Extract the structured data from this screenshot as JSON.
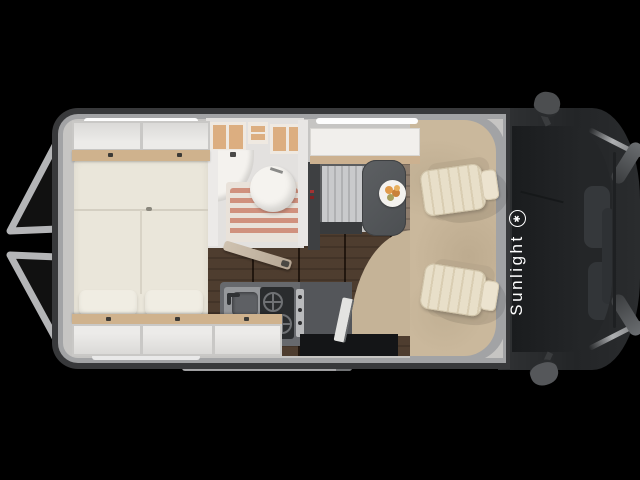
{
  "brand": {
    "name": "Sunlight",
    "logo_glyph": "✱",
    "text_color": "#ffffff"
  },
  "scene": {
    "subject": "camper-van-floor-plan-top-view",
    "orientation": "front-of-vehicle-right",
    "background": "#000000"
  },
  "palette": {
    "van_wall_dark": "#38393b",
    "van_wall_light": "#a2a3a5",
    "interior_base": "#c6c5c3",
    "mattress_cream": "#eae6da",
    "cabinet_white": "#e9e8e6",
    "wood_trim": "#cfb28d",
    "bath_shelf_wood": "#dcae80",
    "shower_slat": "#d0917e",
    "plank_floor": "#8d7d6e",
    "cab_carpet": "#cab89c",
    "seat_cream": "#e8dfc9",
    "table_gray": "#55585b",
    "kitchen_counter": "#67696d",
    "cab_body_dark": "#2a2c2e",
    "windshield": "#1a1c1e"
  }
}
